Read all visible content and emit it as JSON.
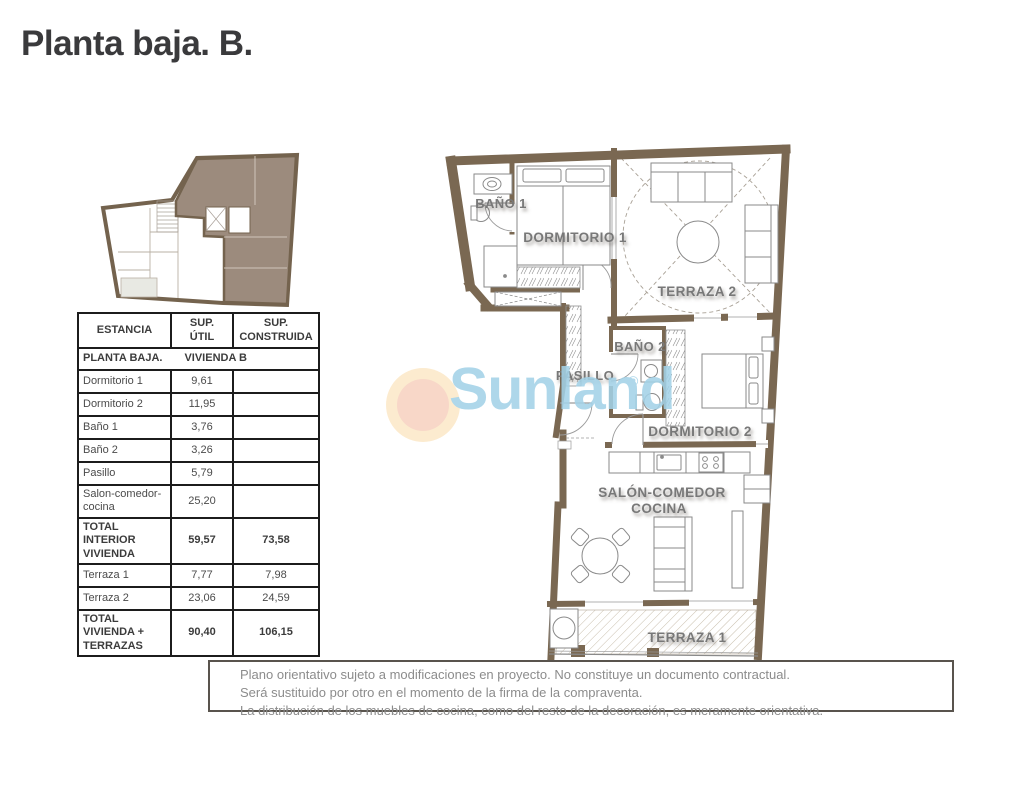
{
  "page": {
    "title": "Planta baja. B."
  },
  "colors": {
    "wall_brown": "#7a6852",
    "unit_highlight": "#9c8b7d",
    "plan_label_gray": "#787878",
    "watermark_blue": "#a3d2e8",
    "sun_outer": "#fce9c9",
    "sun_inner": "#f7d2c1",
    "table_border": "#1c1c1c"
  },
  "watermark": {
    "brand": "Sunland",
    "registered": "®"
  },
  "table": {
    "headers": {
      "estancia": "ESTANCIA",
      "util": "SUP.\nÚTIL",
      "construida": "SUP.\nCONSTRUIDA"
    },
    "section": {
      "left": "PLANTA BAJA.",
      "right": "VIVIENDA B"
    },
    "rows": [
      {
        "estancia": "Dormitorio 1",
        "util": "9,61",
        "construida": "",
        "bold": false
      },
      {
        "estancia": "Dormitorio 2",
        "util": "11,95",
        "construida": "",
        "bold": false
      },
      {
        "estancia": "Baño 1",
        "util": "3,76",
        "construida": "",
        "bold": false
      },
      {
        "estancia": "Baño 2",
        "util": "3,26",
        "construida": "",
        "bold": false
      },
      {
        "estancia": "Pasillo",
        "util": "5,79",
        "construida": "",
        "bold": false
      },
      {
        "estancia": "Salon-comedor-cocina",
        "util": "25,20",
        "construida": "",
        "bold": false
      },
      {
        "estancia": "TOTAL INTERIOR VIVIENDA",
        "util": "59,57",
        "construida": "73,58",
        "bold": true
      },
      {
        "estancia": "Terraza 1",
        "util": "7,77",
        "construida": "7,98",
        "bold": false
      },
      {
        "estancia": "Terraza 2",
        "util": "23,06",
        "construida": "24,59",
        "bold": false
      },
      {
        "estancia": "TOTAL VIVIENDA + TERRAZAS",
        "util": "90,40",
        "construida": "106,15",
        "bold": true
      }
    ]
  },
  "plan": {
    "labels": {
      "bano1": "BAÑO 1",
      "dormitorio1": "DORMITORIO 1",
      "terraza2": "TERRAZA 2",
      "bano2": "BAÑO 2",
      "pasillo": "PASILLO",
      "dormitorio2": "DORMITORIO 2",
      "salon_line1": "SALÓN-COMEDOR",
      "salon_line2": "COCINA",
      "terraza1": "TERRAZA 1"
    }
  },
  "disclaimer": {
    "lines": [
      "Plano orientativo sujeto a modificaciones en proyecto. No constituye un documento contractual.",
      "Será sustituido por otro en el momento de la firma de la compraventa.",
      "La distribución de los muebles de cocina, como del resto de la decoración, es meramente orientativa."
    ]
  }
}
